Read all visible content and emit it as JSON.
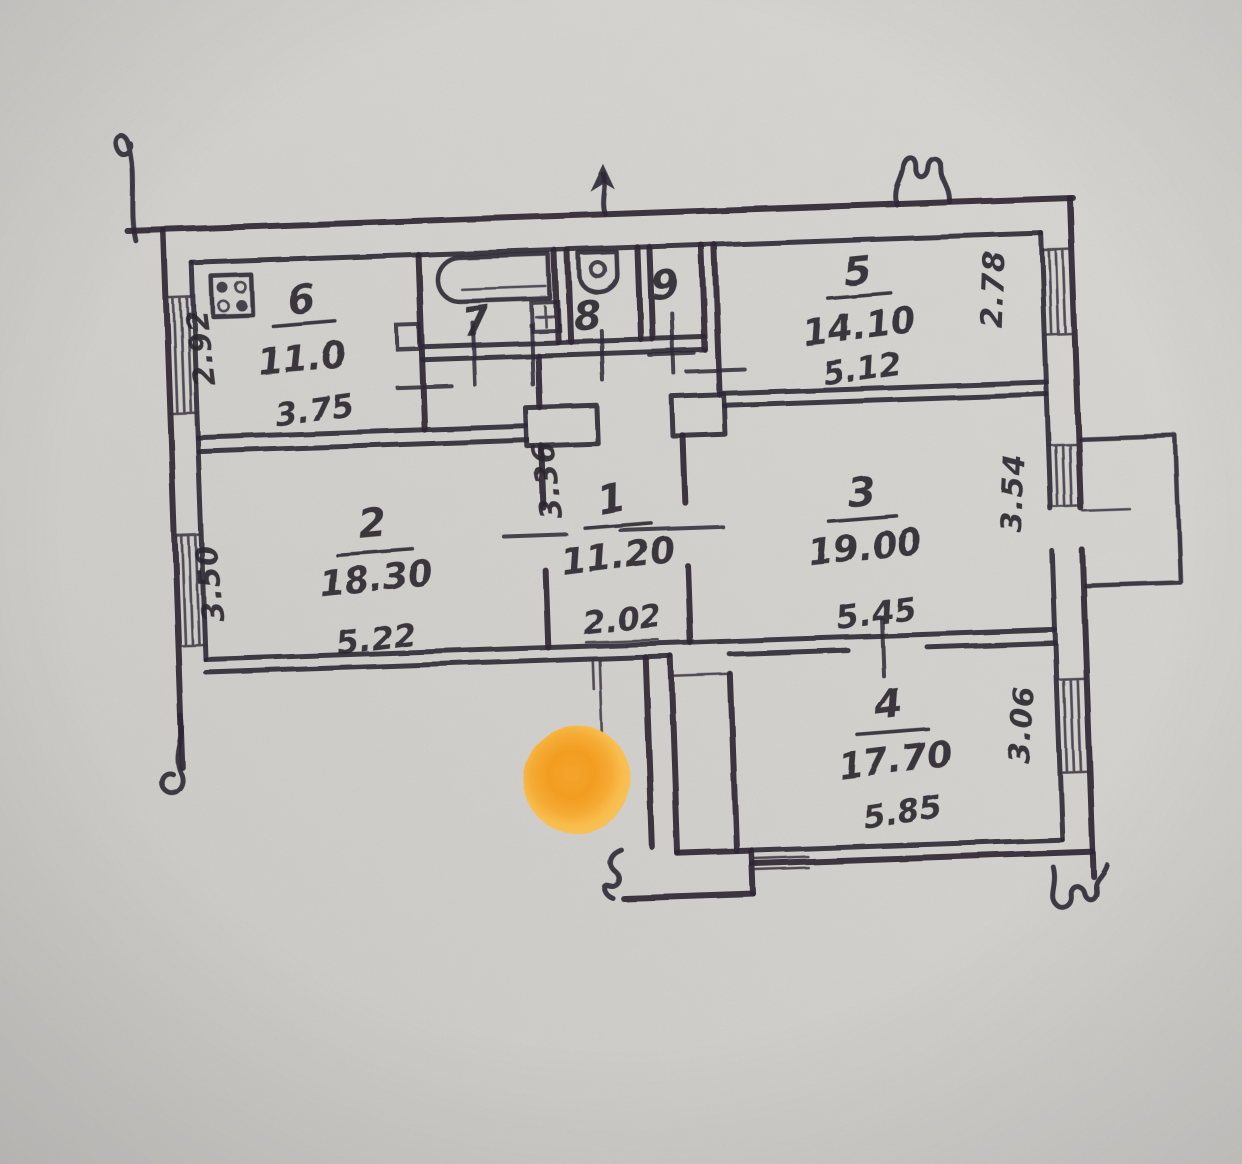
{
  "document": {
    "type": "hand-drawn apartment floor plan, photographed on gray paper"
  },
  "palette": {
    "paper": "#d7d5d1",
    "ink": "#2e2935",
    "marker_core": "#f29d22",
    "marker_edge": "#f8c055"
  },
  "rooms": {
    "r1": {
      "number": "1",
      "area": "11.20",
      "width_dim": "2.02",
      "height_dim": "3.36"
    },
    "r2": {
      "number": "2",
      "area": "18.30",
      "width_dim": "5.22",
      "height_dim": "3.50"
    },
    "r3": {
      "number": "3",
      "area": "19.00",
      "width_dim": "5.45",
      "height_dim": "3.54"
    },
    "r4": {
      "number": "4",
      "area": "17.70",
      "width_dim": "5.85",
      "height_dim": "3.06"
    },
    "r5": {
      "number": "5",
      "area": "14.10",
      "width_dim": "5.12",
      "height_dim": "2.78"
    },
    "r6": {
      "number": "6",
      "area": "11.0",
      "width_dim": "3.75",
      "height_dim": "2.92"
    },
    "r7": {
      "number": "7"
    },
    "r8": {
      "number": "8"
    },
    "r9": {
      "number": "9"
    }
  },
  "marker": {
    "shape": "orange dot sticker"
  }
}
